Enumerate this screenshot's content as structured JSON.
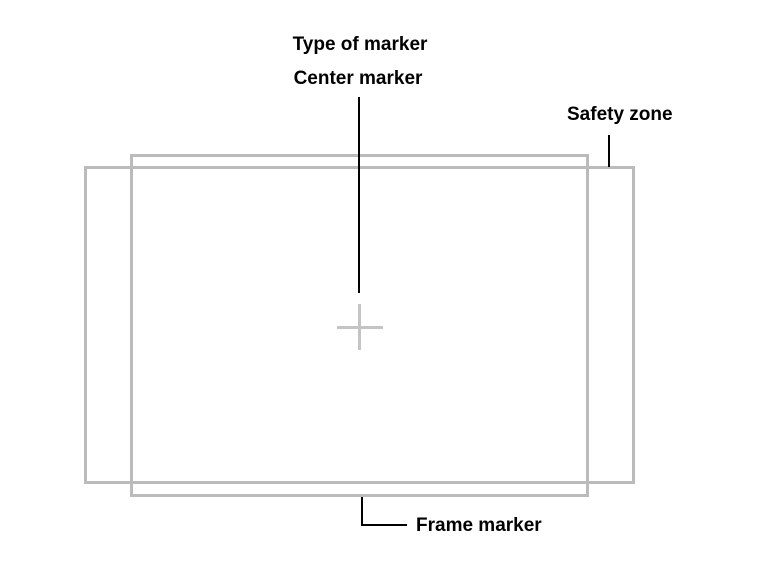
{
  "diagram": {
    "title": "Type of marker",
    "annotations": {
      "center_marker": {
        "label": "Center marker"
      },
      "safety_zone": {
        "label": "Safety zone"
      },
      "frame_marker": {
        "label": "Frame marker"
      }
    },
    "shapes": {
      "frame_marker_rect": "frame-marker-rectangle",
      "safety_zone_rect": "safety-zone-rectangle",
      "center_cross": "center-cross-marker-icon"
    },
    "colors": {
      "rectangle_stroke": "#bbbbbb",
      "cross_stroke": "#c4c4c4",
      "leader_line": "#000000",
      "text": "#000000",
      "background": "#ffffff"
    }
  }
}
